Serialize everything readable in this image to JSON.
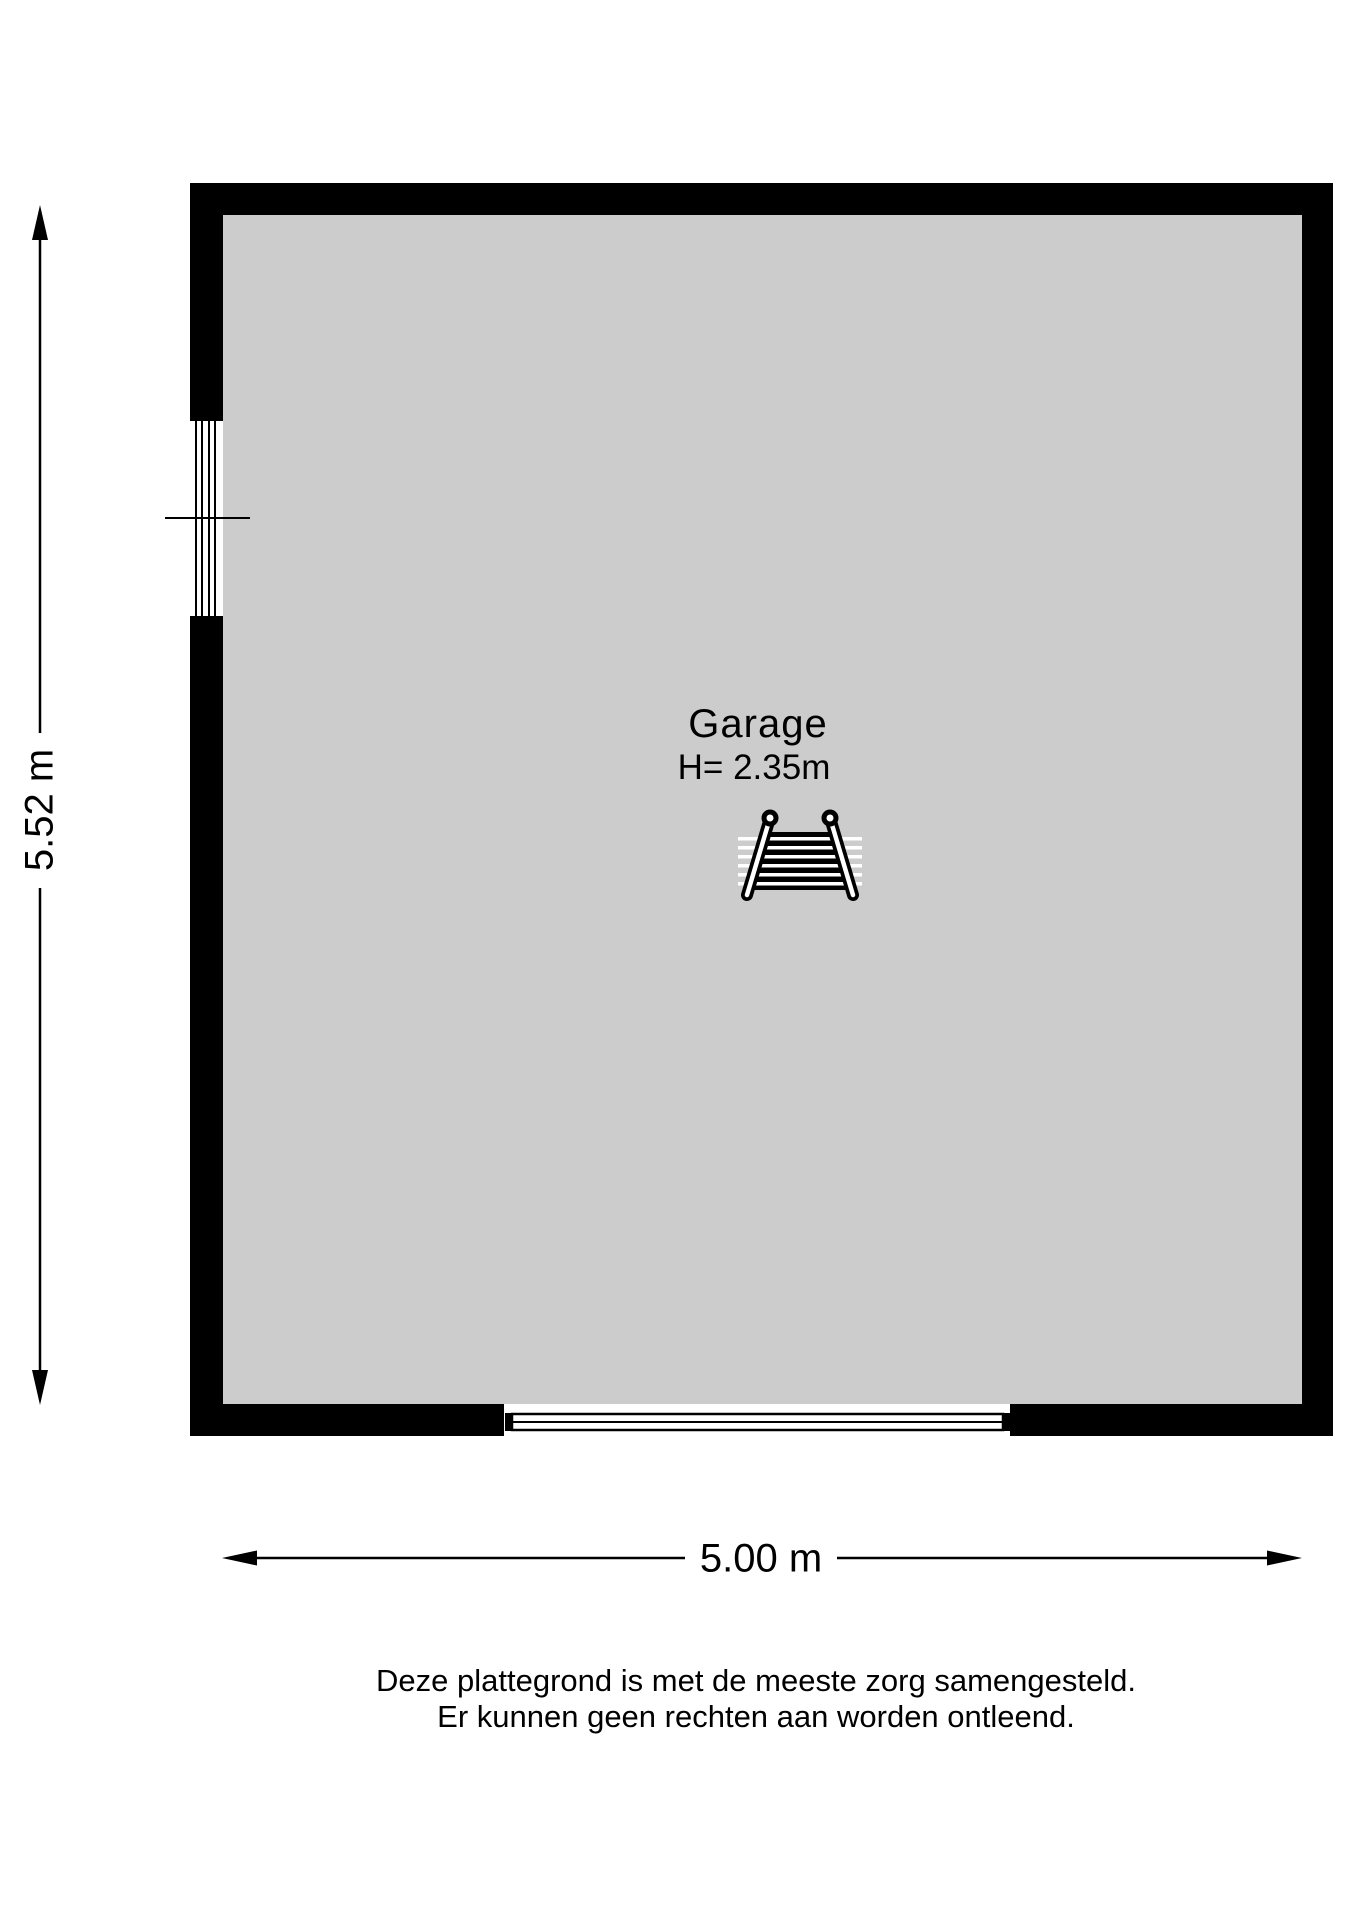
{
  "floor_plan": {
    "room": {
      "name": "Garage",
      "height_label": "H= 2.35m"
    },
    "dimensions": {
      "vertical": "5.52 m",
      "horizontal": "5.00 m"
    },
    "features": {
      "window_wall": "left",
      "garage_door_wall": "bottom",
      "room_icon": "ladder-icon"
    },
    "colors": {
      "wall": "#000000",
      "floor": "#cccccc",
      "lines": "#000000",
      "background": "#ffffff"
    }
  },
  "disclaimer": {
    "line1": "Deze plattegrond is met de meeste zorg samengesteld.",
    "line2": "Er kunnen geen rechten aan worden ontleend."
  }
}
